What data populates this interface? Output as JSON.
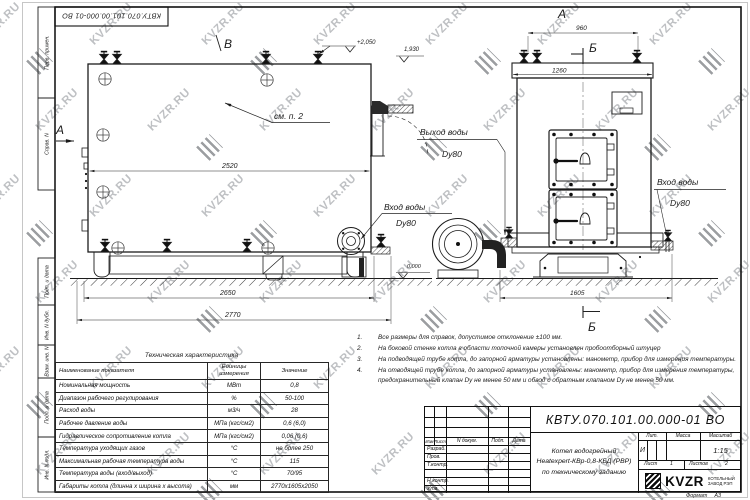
{
  "watermark": {
    "text": "KVZR.RU"
  },
  "sheet": {
    "doc_number_top": "КВТУ.070.101.00.000-01 ВО",
    "margin_labels": [
      "Перв. примен.",
      "Справ. N",
      "Подп. и дата",
      "Инв. N дубл.",
      "Взам. инв. N",
      "Подп. и дата",
      "Инв. N подл."
    ],
    "format_label": "Формат",
    "format_value": "А3"
  },
  "drawing": {
    "markers": {
      "a": "А",
      "b": "Б",
      "v": "В"
    },
    "see_note": "см. п. 2",
    "labels": {
      "water_inlet": "Вход воды",
      "water_outlet": "Выход воды",
      "dn80": "Dy80"
    },
    "dims": {
      "side_body": "2520",
      "side_base": "2650",
      "side_overall": "2770",
      "front_valves": "960",
      "front_body": "1260",
      "front_base": "1605"
    },
    "elevations": {
      "valves": "+2,050",
      "duct": "1,930",
      "ground": "0.000"
    }
  },
  "notes": [
    {
      "num": "1.",
      "text": "Все размеры для справок, допустимое отклонение ±100 мм."
    },
    {
      "num": "2.",
      "text": "На боковой стенке котла в области топочной камеры установлен пробоотборный штуцер"
    },
    {
      "num": "3.",
      "text": "На подводящей трубе котла, до запорной арматуры установлены: манометр, прибор для измерения температуры."
    },
    {
      "num": "4.",
      "text": "На отводящей трубе котла, до запорной арматуры установлены: манометр, прибор для измерения температуры, предохранительный клапан Dу не менее 50 мм и обвод с обратным клапаном Dу не менее 50 мм."
    }
  ],
  "spec_table": {
    "title": "Техническая характеристика",
    "headers": [
      "Наименование показателя",
      "Единицы измерения",
      "Значение"
    ],
    "rows": [
      [
        "Номинальная мощность",
        "МВт",
        "0,8"
      ],
      [
        "Диапазон рабочего регулирования",
        "%",
        "50-100"
      ],
      [
        "Расход воды",
        "м3/ч",
        "28"
      ],
      [
        "Рабочее давление воды",
        "МПа (кгс/см2)",
        "0,6 (6,0)"
      ],
      [
        "Гидравлическое сопротивление котла",
        "МПа (кгс/см2)",
        "0,06 (0,6)"
      ],
      [
        "Температура уходящих газов",
        "°С",
        "не более 250"
      ],
      [
        "Максимальная рабочая температура воды",
        "°С",
        "115"
      ],
      [
        "Температура воды (вход/выход)",
        "°С",
        "70/95"
      ],
      [
        "Габариты котла (длинна х ширина х высота)",
        "мм",
        "2770х1605х2050"
      ]
    ]
  },
  "title_block": {
    "doc_number": "КВТУ.070.101.00.000-01 ВО",
    "header_cols": [
      "Изм",
      "Лист",
      "N докум.",
      "Подп.",
      "Дата"
    ],
    "row_labels": [
      "Разраб.",
      "Пров.",
      "Т.контр.",
      "Н.контр.",
      "Утв."
    ],
    "product_line1": "Котел водогрейный",
    "product_line2": "Heatexpert-КВр-0,8-КБД (РВР)",
    "product_line3": "по техническому заданию",
    "lit_label": "Лит.",
    "mass_label": "Масса",
    "scale_label": "Масштаб",
    "lit_value": "И",
    "scale_value": "1:15",
    "sheet_label": "Лист",
    "sheet_value": "1",
    "sheets_label": "Листов",
    "sheets_value": "2",
    "brand": "KVZR",
    "brand_line1": "КОТЕЛЬНЫЙ",
    "brand_line2": "ЗАВОД РЭП"
  }
}
